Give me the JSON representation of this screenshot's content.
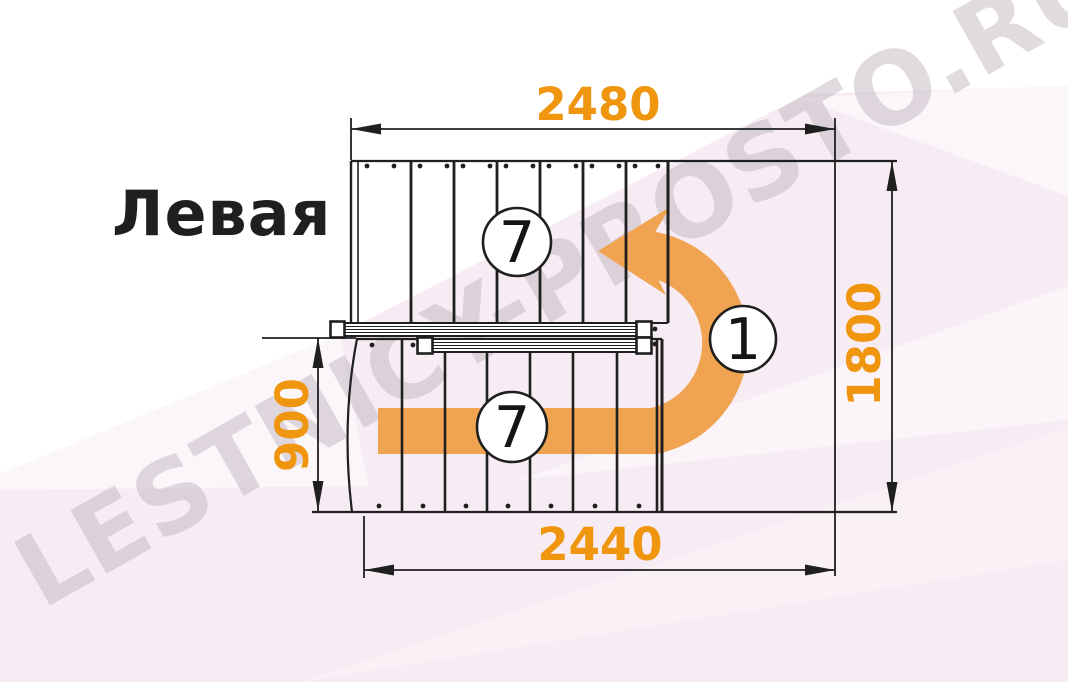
{
  "title": "Левая",
  "watermark": "LESTNICY-PROSTO.RU",
  "diagram": {
    "type": "staircase-plan",
    "dimensions": {
      "top": "2480",
      "right": "1800",
      "left": "900",
      "bottom": "2440"
    },
    "markers": {
      "top_flight_steps": "7",
      "turn_count": "1",
      "bottom_flight_steps": "7"
    },
    "colors": {
      "dimension_text_orange": "#F0950E",
      "arrow_orange": "#F0A452",
      "line_black": "#1F1F1F",
      "background_pink": "#F7ECF3",
      "watermark_gray": "#B9ACB7"
    }
  }
}
